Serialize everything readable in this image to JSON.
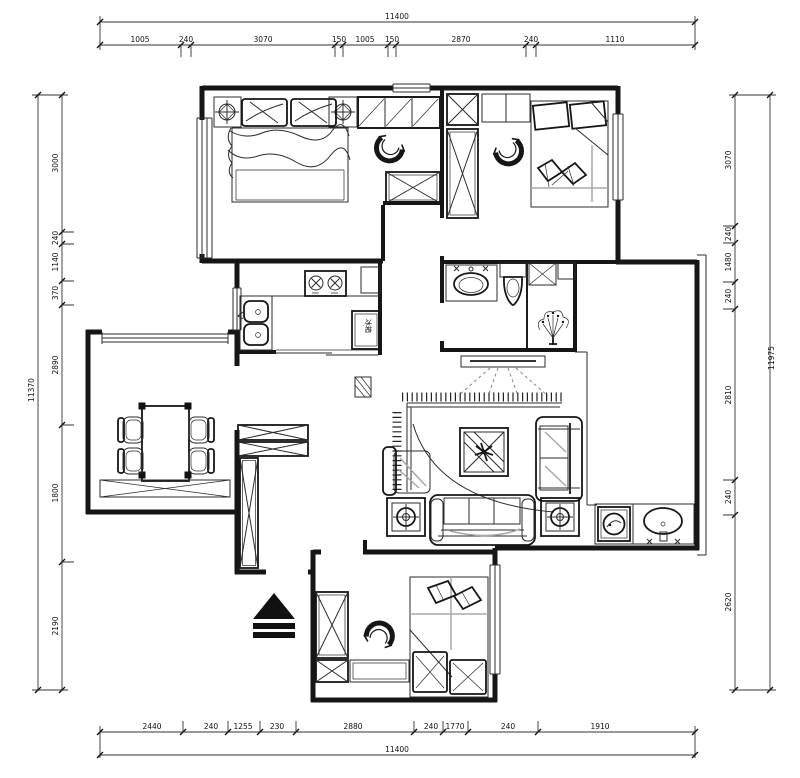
{
  "drawing": {
    "type": "residential floor plan",
    "bg": "#ffffff",
    "wall_color": "#161616",
    "accent_gray": "#a8a8a8",
    "dim_color": "#222222"
  },
  "dimensions": {
    "top": {
      "overall": "11400",
      "segments": [
        "1005",
        "240",
        "3070",
        "150",
        "1005",
        "150",
        "2870",
        "240",
        "1110"
      ]
    },
    "bottom": {
      "overall": "11400",
      "segments": [
        "2440",
        "240",
        "1255",
        "230",
        "2880",
        "240",
        "1770",
        "240",
        "1910"
      ]
    },
    "left": {
      "overall": "11370",
      "segments": [
        "3000",
        "240",
        "1140",
        "370",
        "2890",
        "1800",
        "2190"
      ]
    },
    "right": {
      "overall": "11975",
      "segments": [
        "3070",
        "240",
        "1480",
        "240",
        "2810",
        "240",
        "2620"
      ]
    }
  },
  "labels": {
    "fridge": "冰箱"
  }
}
